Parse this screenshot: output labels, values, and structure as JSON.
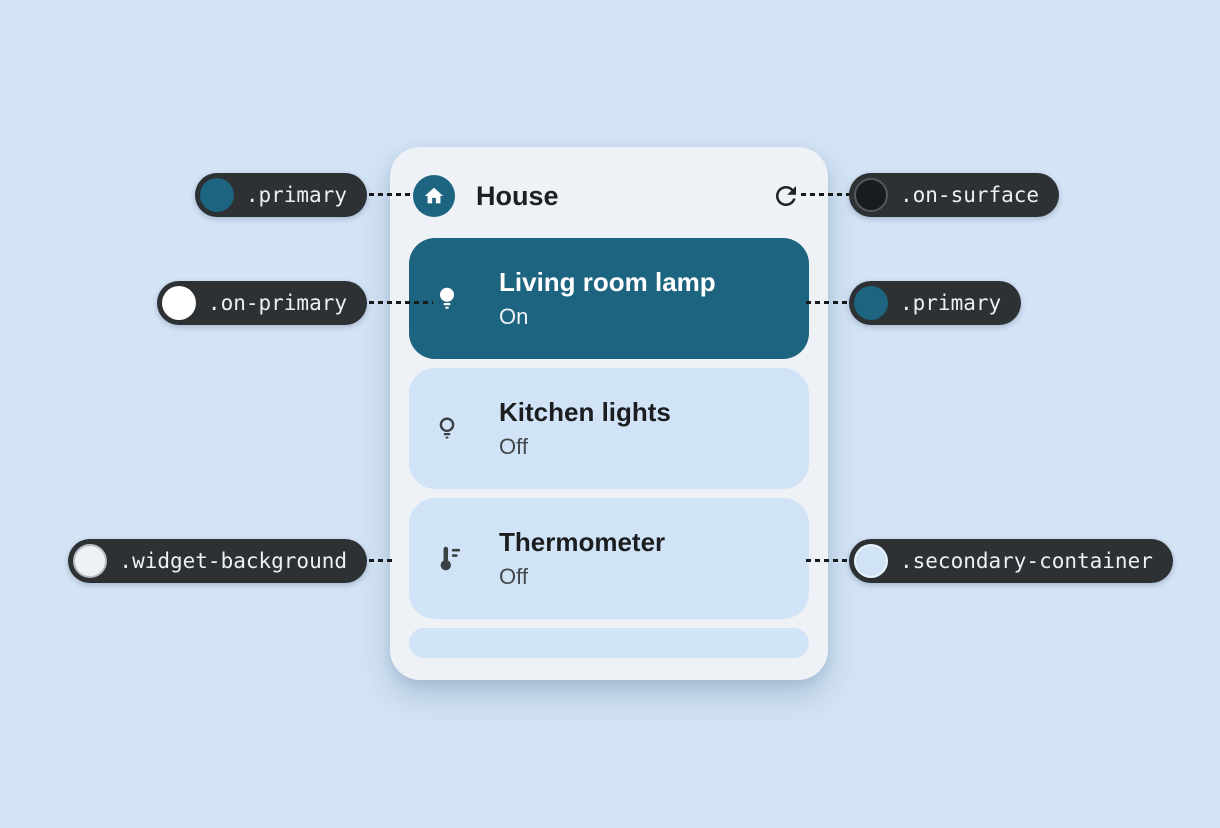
{
  "widget": {
    "title": "House",
    "header_icon": "house",
    "refresh_icon": "refresh",
    "devices": [
      {
        "name": "Living room lamp",
        "status": "On",
        "icon": "lightbulb-filled",
        "state": "on"
      },
      {
        "name": "Kitchen lights",
        "status": "Off",
        "icon": "lightbulb-outline",
        "state": "off"
      },
      {
        "name": "Thermometer",
        "status": "Off",
        "icon": "thermostat",
        "state": "off"
      }
    ]
  },
  "annotations": {
    "left": [
      {
        "token": ".primary",
        "swatch": "#1d6480"
      },
      {
        "token": ".on-primary",
        "swatch": "#ffffff"
      },
      {
        "token": ".widget-background",
        "swatch": "#eef1f6"
      }
    ],
    "right": [
      {
        "token": ".on-surface",
        "swatch": "#191c1e"
      },
      {
        "token": ".primary",
        "swatch": "#1d6480"
      },
      {
        "token": ".secondary-container",
        "swatch": "#d1e4f7"
      }
    ]
  },
  "colors": {
    "canvas_background": "#d3e4f5",
    "widget_background": "#eef1f6",
    "primary": "#1d6480",
    "on_primary": "#ffffff",
    "on_surface": "#191c1e",
    "secondary_container": "#d1e4f7",
    "pill_background": "#2d3134"
  }
}
